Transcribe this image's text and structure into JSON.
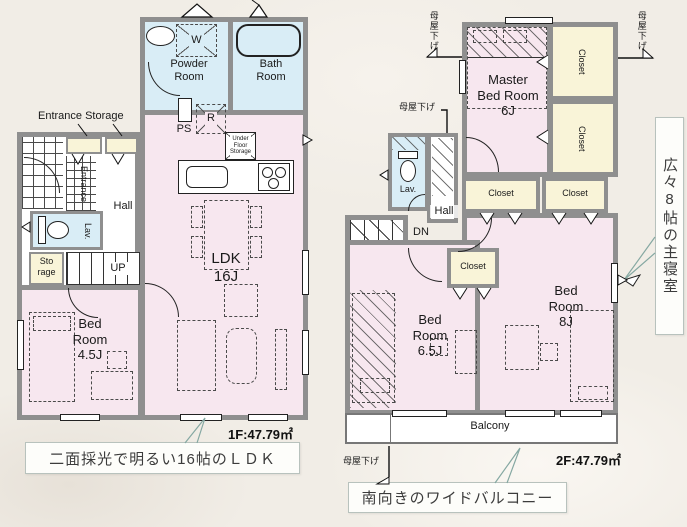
{
  "colors": {
    "background": "#f1ede6",
    "wall_gray": "#8f8f8f",
    "room_pink": "#f7e7ef",
    "water_blue": "#d9edf6",
    "closet_cream": "#f9f4d8",
    "leader_teal": "#85a8a2"
  },
  "floor1": {
    "labels": {
      "entrance_storage": "Entrance Storage",
      "powder_room": "Powder\nRoom",
      "bath_room": "Bath\nRoom",
      "washer": "W",
      "ps": "PS",
      "fridge": "R",
      "under_floor_storage": "Under\nFloor\nStorage",
      "entrance": "Entrance",
      "hall": "Hall",
      "lav": "Lav.",
      "storage": "Sto\nrage",
      "up": "UP",
      "ldk": "LDK\n16J",
      "bedroom": "Bed\nRoom\n4.5J"
    },
    "area": "1F:47.79㎡",
    "callout": "二面採光で明るい16帖のＬＤＫ"
  },
  "floor2": {
    "labels": {
      "master": "Master\nBed Room\n6J",
      "closet": "Closet",
      "lav": "Lav.",
      "hall": "Hall",
      "dn": "DN",
      "bedroom65": "Bed\nRoom\n6.5J",
      "bedroom8": "Bed\nRoom\n8J",
      "balcony": "Balcony",
      "moya_sage": "母屋下げ"
    },
    "area": "2F:47.79㎡",
    "callout": "南向きのワイドバルコニー",
    "side_note": "広々8帖の主寝室"
  }
}
